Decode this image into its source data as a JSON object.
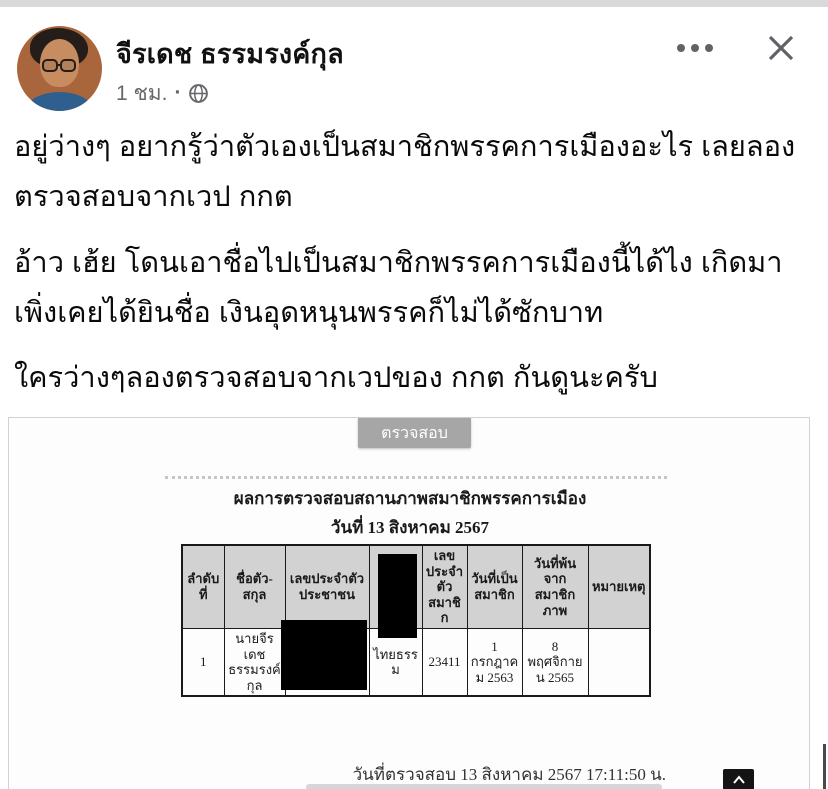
{
  "header": {
    "author": "จีรเดช ธรรมรงค์กุล",
    "timestamp": "1 ชม.",
    "separator": "·"
  },
  "post": {
    "paragraphs": [
      "อยู่ว่างๆ อยากรู้ว่าตัวเองเป็นสมาชิกพรรคการเมืองอะไร เลยลองตรวจสอบจากเวป กกต",
      "อ้าว เฮ้ย โดนเอาชื่อไปเป็นสมาชิกพรรคการเมืองนี้ได้ไง เกิดมาเพิ่งเคยได้ยินชื่อ เงินอุดหนุนพรรคก็ไม่ได้ซักบาท",
      "ใครว่างๆลองตรวจสอบจากเวปของ กกต กันดูนะครับ"
    ]
  },
  "attachment": {
    "check_button": "ตรวจสอบ",
    "title": "ผลการตรวจสอบสถานภาพสมาชิกพรรคการเมือง",
    "subtitle": "วันที่ 13 สิงหาคม 2567",
    "table": {
      "headers": [
        "ลำดับที่",
        "ชื่อตัว-สกุล",
        "เลขประจำตัวประชาชน",
        "",
        "เลขประจำตัวสมาชิก",
        "วันที่เป็นสมาชิก",
        "วันที่พ้นจากสมาชิกภาพ",
        "หมายเหตุ"
      ],
      "row": [
        "1",
        "นายจีรเดช ธรรมรงค์กุล",
        "",
        "ไทยธรรม",
        "23411",
        "1 กรกฎาคม 2563",
        "8 พฤศจิกายน 2565",
        ""
      ]
    },
    "footer_text": "วันที่ตรวจสอบ 13 สิงหาคม 2567 17:11:50 น."
  },
  "colors": {
    "check_button_bg": "#a6a6a6",
    "table_header_bg": "#d2d2d2",
    "redaction": "#000000",
    "meta_gray": "#65676b",
    "top_strip": "#d9d9d9"
  }
}
